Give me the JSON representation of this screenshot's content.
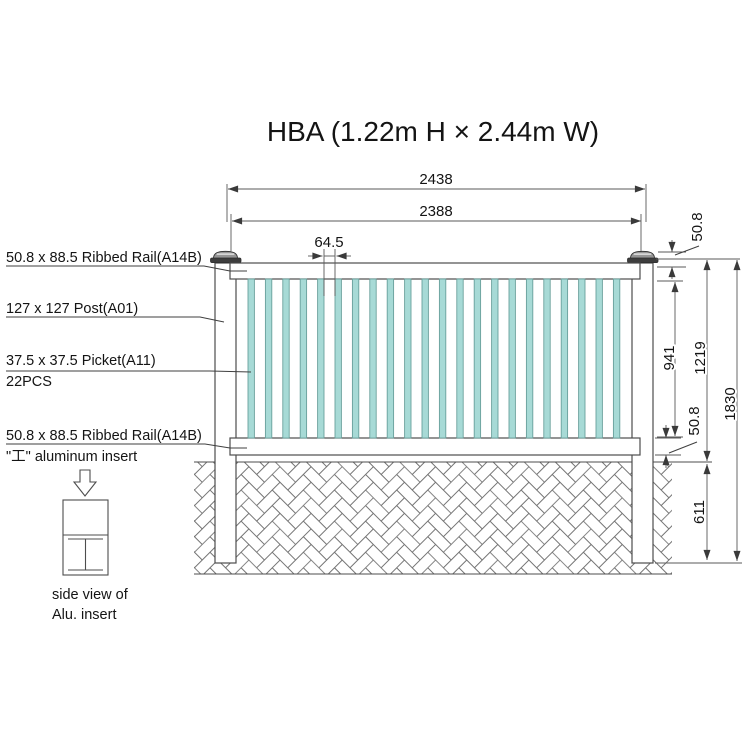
{
  "title": "HBA (1.22m H × 2.44m W)",
  "part_labels": {
    "top_rail": "50.8 x 88.5 Ribbed  Rail(A14B)",
    "post": "127 x 127 Post(A01)",
    "picket": "37.5 x 37.5 Picket(A11)",
    "picket_quantity": "22PCS",
    "bottom_rail": "50.8 x 88.5 Ribbed  Rail(A14B)",
    "aluminum_insert": "\"工\" aluminum insert",
    "side_view_caption_line1": "side view of",
    "side_view_caption_line2": "Alu. insert"
  },
  "dimensions": {
    "overall_width_mm": "2438",
    "rail_width_mm": "2388",
    "picket_spacing_mm": "64.5",
    "top_rail_height_mm": "50.8",
    "picket_opening_height_mm": "941",
    "panel_height_mm": "1219",
    "bottom_rail_height_mm": "50.8",
    "overall_height_mm": "1830",
    "buried_depth_mm": "611"
  },
  "fence": {
    "picket_count": 22,
    "picket_first_x": 248,
    "picket_pitch": 17.4,
    "picket_width": 6.4,
    "picket_top_y": 279,
    "picket_height": 159
  },
  "colors": {
    "picket_fill": "#a7dad6",
    "picket_stroke": "#69a09c",
    "line": "#4d4d4d",
    "dim_line": "#5a5a5a",
    "cap_dark": "#3d3d3d",
    "cap_light": "#969696"
  }
}
